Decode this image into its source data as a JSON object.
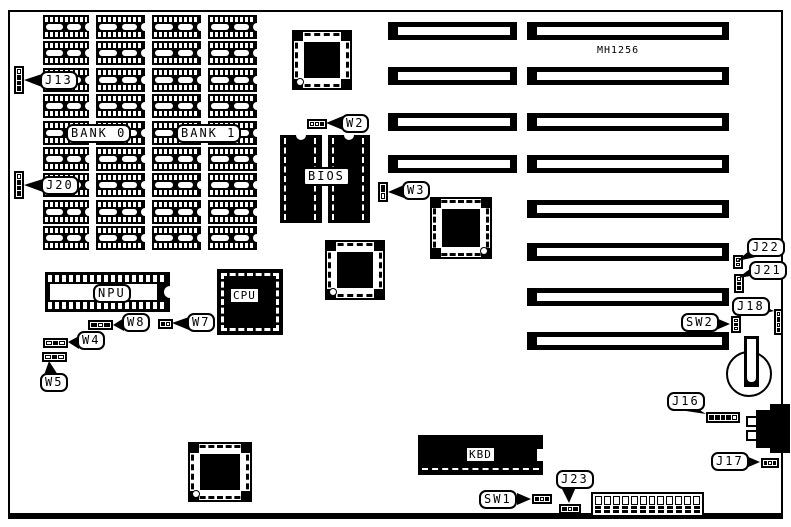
{
  "colors": {
    "ink": "#000000",
    "paper": "#ffffff"
  },
  "board": {
    "part_number": "MH1256"
  },
  "memory": {
    "rows": 9,
    "columns": 4,
    "bank_labels": [
      "BANK 0",
      "BANK 1"
    ]
  },
  "slots": {
    "short_count": 4,
    "long_count": 8
  },
  "chips": {
    "npu": "NPU",
    "cpu": "CPU",
    "bios": "BIOS",
    "kbd": "KBD"
  },
  "connectors": {
    "j13": {
      "label": "J13",
      "pins": "wbbb"
    },
    "j20": {
      "label": "J20",
      "pins": "wbbb"
    },
    "w2": {
      "label": "W2",
      "pins": "wwb"
    },
    "w3": {
      "label": "W3",
      "pins": "bw"
    },
    "w4": {
      "label": "W4",
      "pins": "wbw"
    },
    "w5": {
      "label": "W5",
      "pins": "wbw"
    },
    "w7": {
      "label": "W7",
      "pins": "bw"
    },
    "w8": {
      "label": "W8",
      "pins": "bwb"
    },
    "j16": {
      "label": "J16",
      "pins": "bbbbw"
    },
    "j17": {
      "label": "J17",
      "pins": "bwb"
    },
    "j18": {
      "label": "J18",
      "pins": "wbwb"
    },
    "j21": {
      "label": "J21",
      "pins": "wbb"
    },
    "j22": {
      "label": "J22",
      "pins": "ww"
    },
    "j23": {
      "label": "J23",
      "pins": "bwb"
    },
    "sw1": {
      "label": "SW1",
      "pins": "bwb"
    },
    "sw2": {
      "label": "SW2",
      "pins": "wbw"
    }
  }
}
